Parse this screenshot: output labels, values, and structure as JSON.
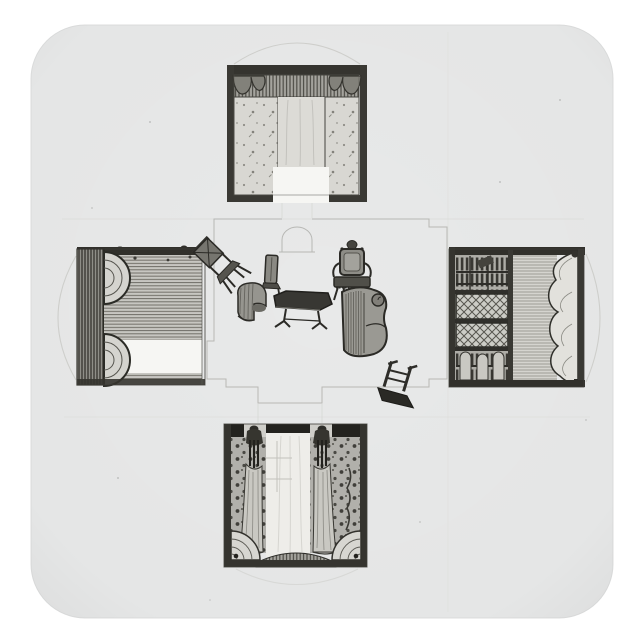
{
  "product": {
    "kind": "square sticker",
    "corner_style": "rounded",
    "backdrop": "white"
  },
  "colors": {
    "page_background": "#ffffff",
    "sticker_paper": "#e8e9e9",
    "paper_edge": "#dcdddd",
    "ink_dark": "#2b2a26",
    "ink_black": "#23221e",
    "wash_mid": "#c7c6c1",
    "wash_light": "#d6d5d0",
    "cutout_white": "#f6f6f3",
    "sheer_white": "#eeede9",
    "plan_line": "#b2b2ae",
    "guide_line": "#d6d6d2"
  },
  "artwork": {
    "subject": "fold-out interior design drawing in grey wash",
    "center_panel": "floor plan with scattered furniture",
    "top_wall": "wall with striped pelmet, corner swags and sprigged wallpaper",
    "left_wall": "boarded wall with scalloped drapery border and chimney cut-out",
    "right_wall": "library wall with lattice-front bookcases and scalloped drapery edge",
    "bottom_wall": "curtained window wall with figural tie-backs and spotted wallpaper",
    "furniture": [
      "overturned side chair",
      "side chair",
      "carved armchair",
      "tub chair",
      "centre table",
      "chaise longue",
      "overturned stand"
    ]
  }
}
